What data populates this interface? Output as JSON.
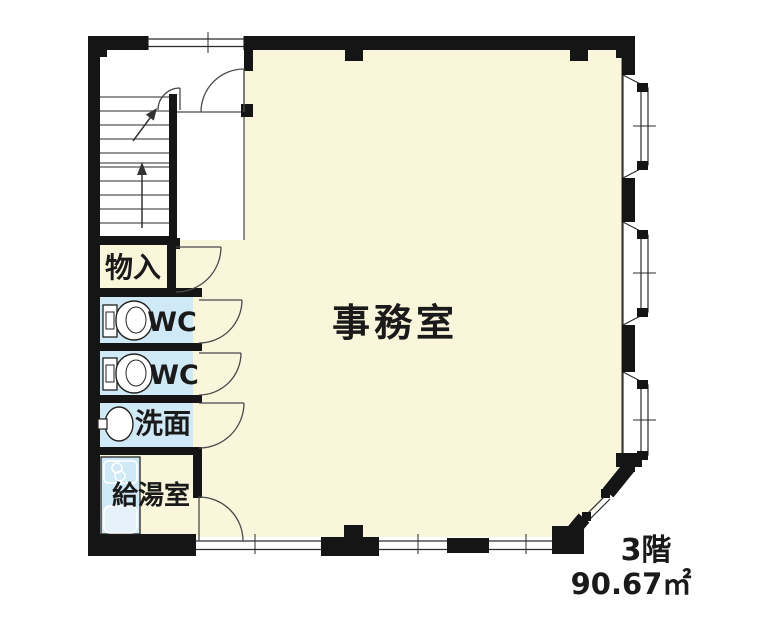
{
  "plan": {
    "rooms": {
      "office": {
        "label": "事務室"
      },
      "storage": {
        "label": "物入"
      },
      "wc_upper": {
        "label": "WC"
      },
      "wc_lower": {
        "label": "WC"
      },
      "washroom": {
        "label": "洗面"
      },
      "kitchenette": {
        "label": "給湯室"
      }
    },
    "floor_note": {
      "floor": "3階",
      "area": "90.67㎡"
    },
    "colors": {
      "floor_cream": "#FAF6DC",
      "wet_area_blue": "#D0E9F6",
      "sink_fill": "#E6F2FA",
      "wall_black": "#151515",
      "background": "#FFFFFF"
    },
    "features": [
      "staircase",
      "entry-double-door",
      "bay-window-x3",
      "corner-window",
      "toilet-x2",
      "washbasin",
      "kitchen-counter"
    ]
  }
}
